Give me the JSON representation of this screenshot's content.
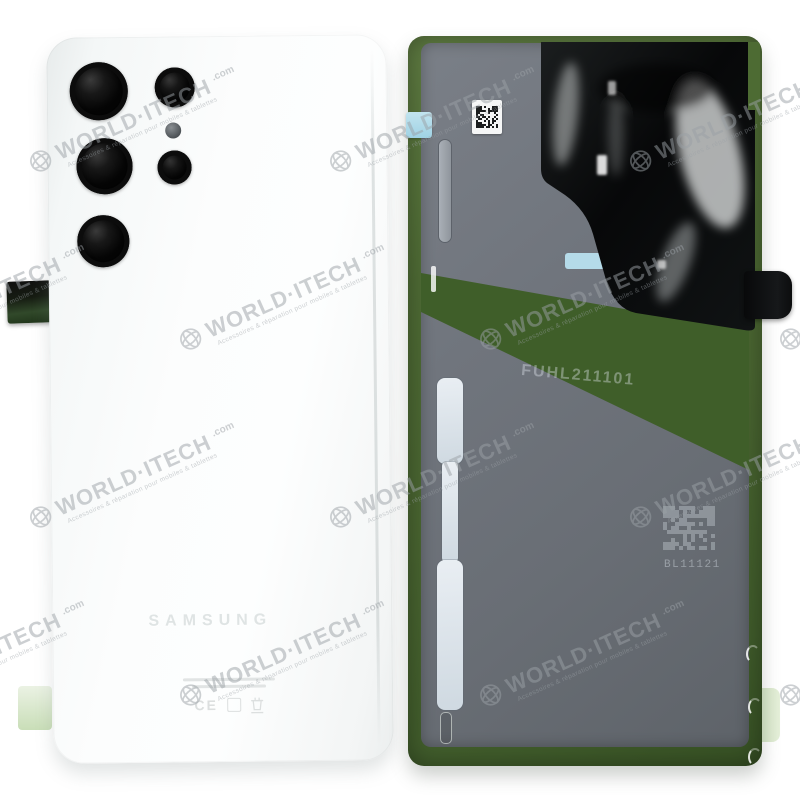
{
  "watermark": {
    "brand": "WORLD·ITECH",
    "tld": ".com",
    "tagline": "Accessoires & réparation pour mobiles & tablettes",
    "color": "#9ba1a6"
  },
  "product": {
    "left_cover": {
      "brand_logo": "SAMSUNG",
      "regulatory": {
        "ce_mark": "CE"
      }
    },
    "right_cover": {
      "etched_serial": "FUHL211101",
      "etched_batch_code": "BL11121"
    },
    "colors": {
      "cover_white": "#f7f9f9",
      "inside_gray": "#6b7077",
      "adhesive_green": "#4b6a32",
      "band_green": "#3f5e29",
      "foil_black": "#0b0d0e",
      "liner_blue": "#dfe6ec",
      "tab_cyan": "#a9d8e8",
      "tab_pale_green": "#d7e7ca"
    }
  }
}
